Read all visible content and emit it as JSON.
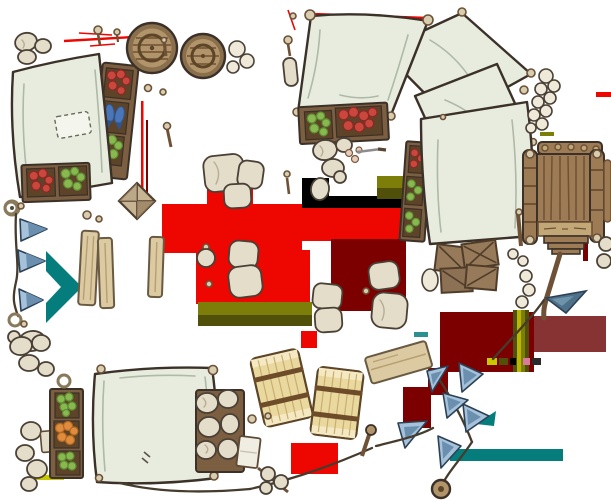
{
  "scene": {
    "description": "Top-down fantasy market battlemap asset sheet: stalls with canvas awnings, produce crates, barrels, tents, a wooden cart, sacks, hay bales, planks, crate stacks and blue pennant bunting, on a white background with transparency-artifact color patches",
    "width": 611,
    "height": 500
  },
  "palette": {
    "bg": "#ffffff",
    "ink": "#3b3128",
    "canvas": "#e7ecdf",
    "canvas_fold": "#aeb9a6",
    "canvas_patch": "#f4f6ee",
    "sack": "#e4ddc9",
    "sack_white": "#efe9da",
    "sack_shade": "#b7ad93",
    "sack_dark": "#4a4036",
    "crate_frame": "#7c5e40",
    "crate_inner": "#5d4328",
    "knob": "#d9cdb0",
    "knob_stroke": "#6b5138",
    "wood": "#9c7b55",
    "wood_light": "#c2a877",
    "wood_dark": "#6f5136",
    "barrel_rim": "#8a6f4c",
    "barrel_top": "#b2946a",
    "hoop": "#5d4527",
    "plank": "#dccaa2",
    "plank_edge": "#6b5a42",
    "plank_line": "#b89f72",
    "hay": "#ead99e",
    "hay_light": "#f4e9c2",
    "hay_line": "#c9ad72",
    "strap": "#6e4c2a",
    "goods_red": "#c9473d",
    "goods_red_dark": "#8c2824",
    "goods_green": "#88b84f",
    "goods_green_dark": "#5f8f33",
    "goods_orange": "#df8c3f",
    "fish_blue": "#4a76b8",
    "fish_blue_dark": "#2f5590",
    "flag_light": "#a6c2da",
    "flag_mid": "#6b8fae",
    "flag_dark": "#2c4156",
    "flag_steel": "#4e7089",
    "flag_steel_hi": "#6e93ab",
    "rope": "#453c2e",
    "art_red": "#ee0600",
    "art_maroon": "#7c0000",
    "art_maroon_soft": "#6a0000",
    "art_olive": "#7d7d0a",
    "art_olive_dark": "#50500a",
    "art_olive_bright": "#b8b800",
    "art_yellow": "#c8c800",
    "art_teal": "#057d7d",
    "art_black": "#000000",
    "art_pink": "#d87a9a",
    "art_grey": "#2a2a2a"
  },
  "objects": [
    {
      "id": "stall-top-left",
      "label": "market stall, canvas roof with crates of red goods, blue fish and greens",
      "bbox": [
        8,
        28,
        135,
        218
      ]
    },
    {
      "id": "barrel-large",
      "label": "wooden barrel top view",
      "bbox": [
        127,
        23,
        178,
        74
      ]
    },
    {
      "id": "barrel-small",
      "label": "wooden barrel top view",
      "bbox": [
        181,
        33,
        225,
        78
      ]
    },
    {
      "id": "awning-top-right",
      "label": "large canvas awning with corner knobs",
      "bbox": [
        288,
        8,
        435,
        120
      ]
    },
    {
      "id": "canvas-panels",
      "label": "two overlapping canvas sheets",
      "bbox": [
        375,
        12,
        536,
        180
      ]
    },
    {
      "id": "tent-big",
      "label": "large tent with side crate rack",
      "bbox": [
        403,
        100,
        536,
        246
      ]
    },
    {
      "id": "crates-produce-row",
      "label": "crate row with greens and red meat",
      "bbox": [
        298,
        103,
        388,
        142
      ]
    },
    {
      "id": "cart",
      "label": "wooden hand cart, top view, with drawbar and steel-blue pennant",
      "bbox": [
        515,
        130,
        611,
        320
      ]
    },
    {
      "id": "crate-stack",
      "label": "stack of slatted wooden crates",
      "bbox": [
        424,
        240,
        500,
        295
      ]
    },
    {
      "id": "crate-diamond",
      "label": "pyramid-lid crate",
      "bbox": [
        118,
        182,
        156,
        220
      ]
    },
    {
      "id": "planks-left",
      "label": "three leaning planks",
      "bbox": [
        78,
        214,
        165,
        310
      ]
    },
    {
      "id": "bunting-left",
      "label": "vertical rope with three blue pennants",
      "bbox": [
        5,
        202,
        50,
        354
      ]
    },
    {
      "id": "sacks-mid",
      "label": "scattered grain sacks",
      "bbox": [
        196,
        148,
        410,
        335
      ]
    },
    {
      "id": "hay-bales",
      "label": "two strapped hay bundles",
      "bbox": [
        250,
        345,
        362,
        440
      ]
    },
    {
      "id": "plank-sign",
      "label": "tilted wooden board",
      "bbox": [
        363,
        338,
        433,
        388
      ]
    },
    {
      "id": "stall-bottom-left",
      "label": "market stall with green/orange crates and sack bin",
      "bbox": [
        40,
        330,
        260,
        492
      ]
    },
    {
      "id": "bunting-bottom-right",
      "label": "rope line with light-blue pennants, pegs and knot",
      "bbox": [
        250,
        360,
        590,
        500
      ]
    },
    {
      "id": "sack-pile-right",
      "label": "cascading sack pile beside tents",
      "bbox": [
        522,
        60,
        560,
        135
      ]
    },
    {
      "id": "sack-chain-right",
      "label": "small sack column between tent and cart",
      "bbox": [
        505,
        246,
        536,
        310
      ]
    }
  ],
  "artifacts": {
    "label": "transparency garbage patches baked into the image",
    "patches": [
      {
        "color": "#ee0600",
        "region": "large center block x162-406 y186-304"
      },
      {
        "color": "#7c0000",
        "region": "maroon blocks x331-406 y239-311, x440-606 y312-372, x403-448 y368-428"
      },
      {
        "color": "#000000",
        "region": "black band x302-407 y178-208"
      },
      {
        "color": "#7d7d0a",
        "region": "olive bands x198-312 y302-326, x377-408 y176-199, stripes x513-529 y310-372"
      },
      {
        "color": "#057d7d",
        "region": "teal arrow x46-82 y251-323, teal band x450-563 y449-461"
      },
      {
        "color": "#ee0600",
        "region": "red scribbles top-left and top-right, small block x291-338 y443-474"
      }
    ]
  }
}
